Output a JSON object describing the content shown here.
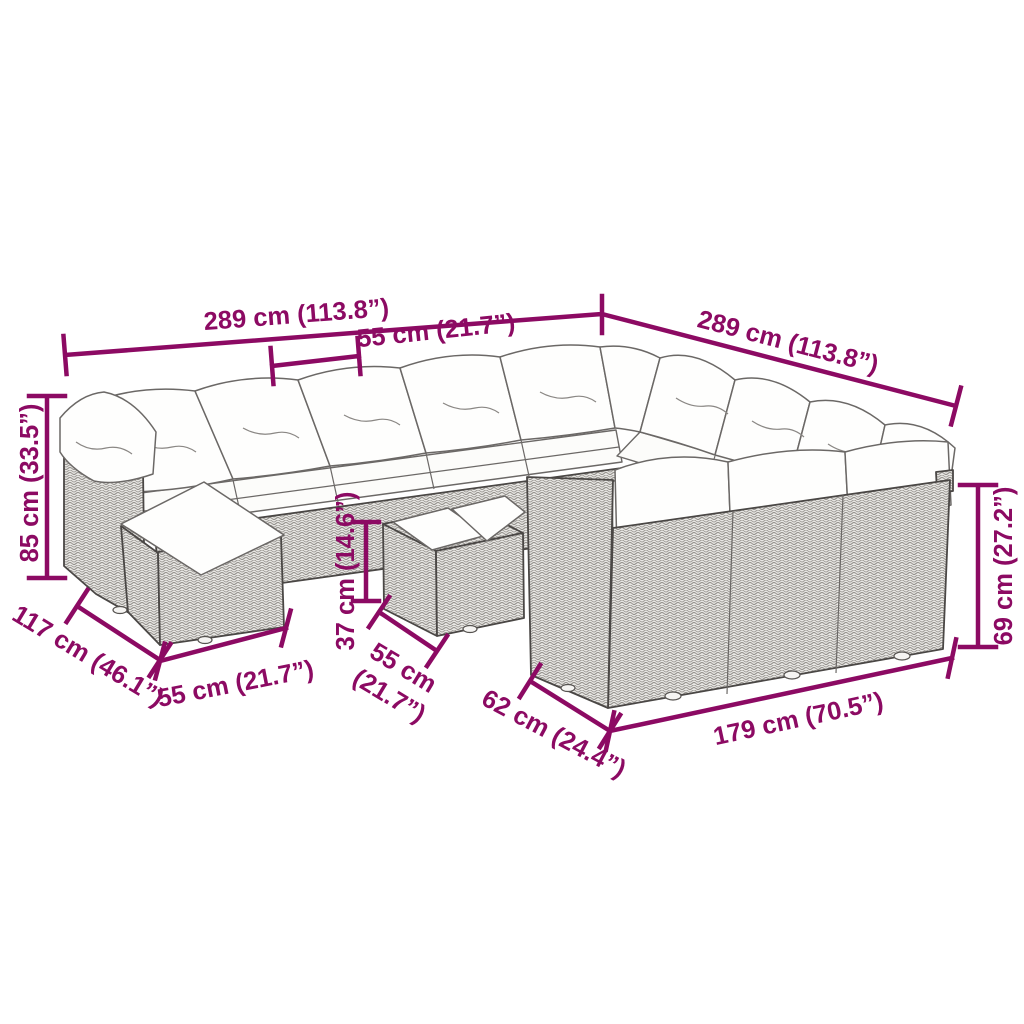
{
  "illustration": {
    "name": "garden-sofa-set-line-drawing",
    "parts": [
      "back sofa row with cushions",
      "left armrest with pillow",
      "footstool with cushion",
      "coffee table with two seat pads",
      "right sofa row with cushions",
      "front sofa section"
    ]
  },
  "colors": {
    "dimension": "#8c0a63",
    "outline": "#4a4745",
    "rattan_fill": "#e8e7e4",
    "rattan_weave": "#97948f",
    "cushion": "#fefefd"
  },
  "dimensions": {
    "back_width": "289 cm (113.8”)",
    "right_width": "289 cm (113.8”)",
    "seat_width": "55 cm (21.7”)",
    "total_height": "85 cm (33.5”)",
    "total_depth": "117 cm (46.1”)",
    "ottoman_width": "55 cm (21.7”)",
    "table_height": "37 cm (14.6”)",
    "table_width_line1": "55 cm",
    "table_width_line2": "(21.7”)",
    "front_depth": "62 cm (24.4”)",
    "front_width": "179 cm (70.5”)",
    "front_height": "69 cm (27.2”)"
  }
}
